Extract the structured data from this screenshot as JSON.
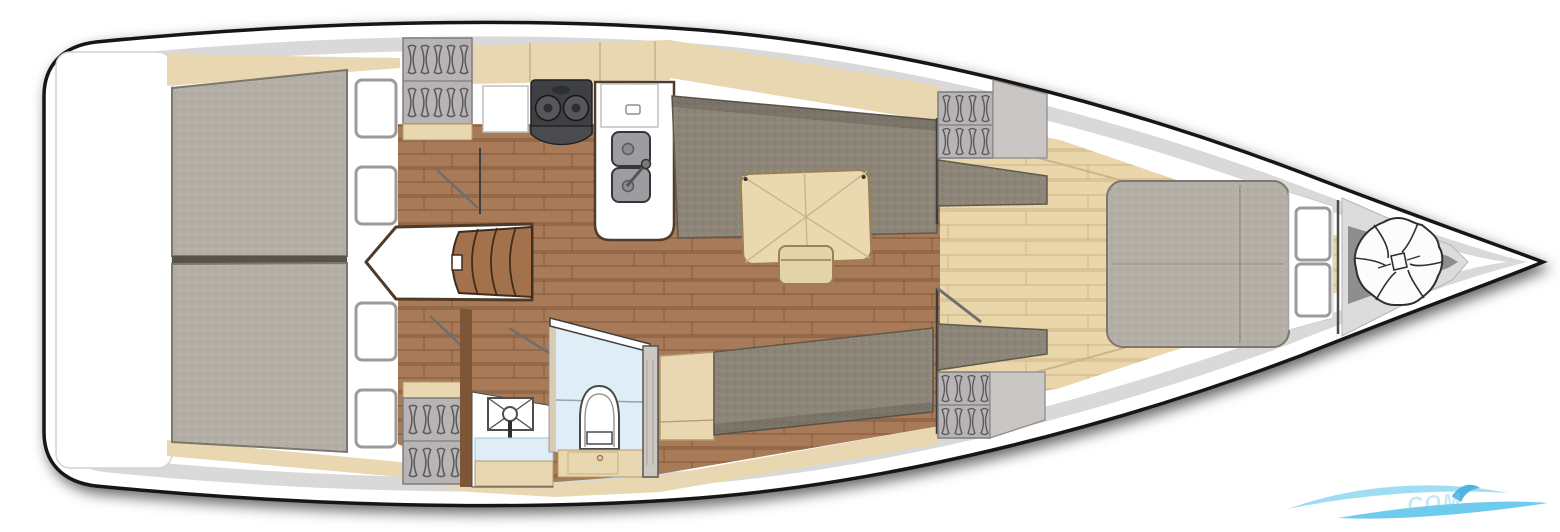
{
  "image": {
    "type": "boat-interior-floor-plan",
    "view": "top-down deck layout",
    "orientation": {
      "stern": "left",
      "bow": "right"
    }
  },
  "legend": [
    {
      "id": "stern-platform",
      "label": "stern platform"
    },
    {
      "id": "aft-cabin",
      "label": "aft double cabin, two berths"
    },
    {
      "id": "companionway",
      "label": "companionway steps"
    },
    {
      "id": "galley",
      "label": "galley with stove and double sink"
    },
    {
      "id": "salon",
      "label": "salon with settees and table"
    },
    {
      "id": "head",
      "label": "head with shower and toilet"
    },
    {
      "id": "forward-cabin",
      "label": "forward cabin with island berth"
    },
    {
      "id": "anchor-locker",
      "label": "bow anchor locker with rope coil"
    }
  ],
  "fixtures": {
    "aft_deck_hatches": 4,
    "bow_hatches": 2,
    "hanging_lockers": 4,
    "berths": 3,
    "stove_burners": 2,
    "sink_bowls": 2
  },
  "colors": {
    "outline": "#161616",
    "hull": "#ffffff",
    "deck_stripe": "#d9d9d9",
    "trim_wood": "#e8d7b0",
    "trim_wood_edge": "#b49b6d",
    "dark_floor": "#a97a57",
    "light_floor": "#e9d6ab",
    "mattress": "#b4afa6",
    "mattress_edge": "#7c766c",
    "settee": "#8d8577",
    "settee_edge": "#5f594e",
    "table": "#ead9b0",
    "table_edge": "#9c8050",
    "bench": "#e3d3a9",
    "stove": "#3f4043",
    "sink": "#9b9da0",
    "sink_edge": "#35353a",
    "locker": "#b8b4b5",
    "locker_edge": "#7d7d7d",
    "cabinet": "#c9c6c3",
    "wood_wall": "#7d5638",
    "step_wood": "#a4714d",
    "step_edge": "#3e2d1d",
    "shower_floor": "#dfeef6",
    "white": "#ffffff",
    "anchor_bay": "#dcdcdc",
    "anchor_shadow": "#8e8e8e",
    "door_swing": "#6e6e6e",
    "watermark_light": "#8fd8f2",
    "watermark_mid": "#56c3ec",
    "watermark_dark": "#2fa9dd"
  },
  "watermark": {
    "text": "COM"
  }
}
